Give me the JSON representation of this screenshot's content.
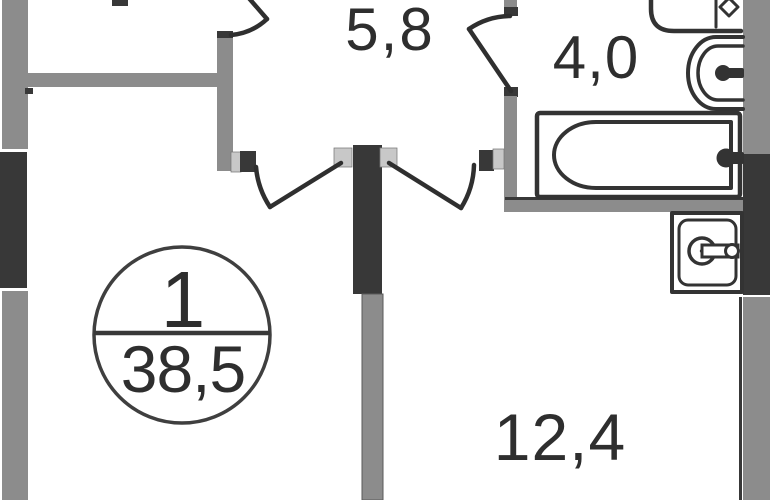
{
  "plan": {
    "type": "apartment-floor-plan",
    "labels": {
      "hall_area": "5,8",
      "bathroom_area": "4,0",
      "room_area": "12,4",
      "unit_number": "1",
      "total_area": "38,5"
    },
    "colors": {
      "background": "#ffffff",
      "wall_gray": "#8c8c8c",
      "wall_dark": "#383838",
      "jamb_light": "#c8c8c8",
      "door_line": "#2f2f2f",
      "fixture_line": "#333333",
      "text": "#2e2e2e"
    },
    "fixtures": [
      {
        "name": "sink-counter"
      },
      {
        "name": "washbasin"
      },
      {
        "name": "bathtub"
      },
      {
        "name": "washing-machine"
      }
    ]
  }
}
